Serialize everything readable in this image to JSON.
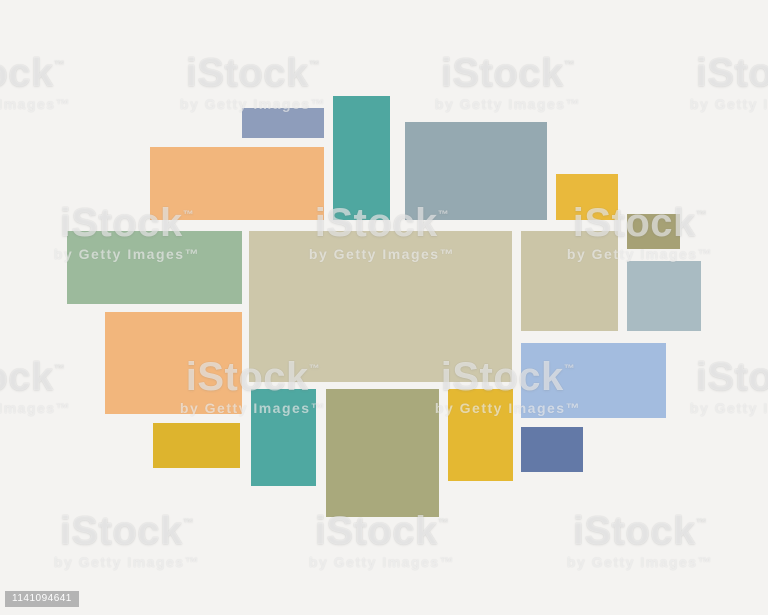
{
  "page": {
    "background": "#f4f3f1",
    "width": 768,
    "height": 615
  },
  "stock_id": "1141094641",
  "watermark": {
    "brand": "iStock",
    "brand_tm": "™",
    "byline": "by Getty Images™"
  },
  "watermark_tiles": [
    {
      "cx": -2,
      "cy": 82
    },
    {
      "cx": 253,
      "cy": 82
    },
    {
      "cx": 508,
      "cy": 82
    },
    {
      "cx": 763,
      "cy": 82
    },
    {
      "cx": 127,
      "cy": 232
    },
    {
      "cx": 382,
      "cy": 232
    },
    {
      "cx": 640,
      "cy": 232
    },
    {
      "cx": -2,
      "cy": 386
    },
    {
      "cx": 253,
      "cy": 386
    },
    {
      "cx": 508,
      "cy": 386
    },
    {
      "cx": 763,
      "cy": 386
    },
    {
      "cx": 127,
      "cy": 540
    },
    {
      "cx": 382,
      "cy": 540
    },
    {
      "cx": 640,
      "cy": 540
    }
  ],
  "collage": {
    "description": "mood-board collage template of colored rectangles",
    "blocks": [
      {
        "name": "top-slate-blue",
        "color": "#8E9DBB",
        "x": 242,
        "y": 108,
        "w": 82,
        "h": 30
      },
      {
        "name": "top-orange",
        "color": "#F2B67C",
        "x": 150,
        "y": 147,
        "w": 174,
        "h": 73
      },
      {
        "name": "top-teal",
        "color": "#4FA7A0",
        "x": 333,
        "y": 96,
        "w": 57,
        "h": 124
      },
      {
        "name": "top-gray-blue",
        "color": "#95A9B1",
        "x": 405,
        "y": 122,
        "w": 142,
        "h": 98
      },
      {
        "name": "top-yellow",
        "color": "#E9B93C",
        "x": 556,
        "y": 174,
        "w": 62,
        "h": 46
      },
      {
        "name": "top-olive",
        "color": "#A6A175",
        "x": 627,
        "y": 214,
        "w": 53,
        "h": 35
      },
      {
        "name": "mid-sage-green",
        "color": "#9CBA9C",
        "x": 67,
        "y": 231,
        "w": 175,
        "h": 73
      },
      {
        "name": "center-beige",
        "color": "#CDC7AA",
        "x": 249,
        "y": 231,
        "w": 263,
        "h": 151
      },
      {
        "name": "mid-right-beige",
        "color": "#CBC5A7",
        "x": 521,
        "y": 231,
        "w": 97,
        "h": 100
      },
      {
        "name": "mid-right-gray-blue",
        "color": "#A9BBC2",
        "x": 627,
        "y": 261,
        "w": 74,
        "h": 70
      },
      {
        "name": "mid-left-orange",
        "color": "#F2B67C",
        "x": 105,
        "y": 312,
        "w": 137,
        "h": 102
      },
      {
        "name": "mid-periwinkle",
        "color": "#A3BCDF",
        "x": 521,
        "y": 343,
        "w": 145,
        "h": 75
      },
      {
        "name": "bottom-yellow-left",
        "color": "#DDB42E",
        "x": 153,
        "y": 423,
        "w": 87,
        "h": 45
      },
      {
        "name": "bottom-teal",
        "color": "#4FA8A1",
        "x": 251,
        "y": 389,
        "w": 65,
        "h": 97
      },
      {
        "name": "bottom-olive",
        "color": "#A9A97C",
        "x": 326,
        "y": 389,
        "w": 113,
        "h": 128
      },
      {
        "name": "bottom-yellow-mid",
        "color": "#E4B832",
        "x": 448,
        "y": 389,
        "w": 65,
        "h": 92
      },
      {
        "name": "bottom-slate-blue",
        "color": "#6379A7",
        "x": 521,
        "y": 427,
        "w": 62,
        "h": 45
      }
    ]
  }
}
